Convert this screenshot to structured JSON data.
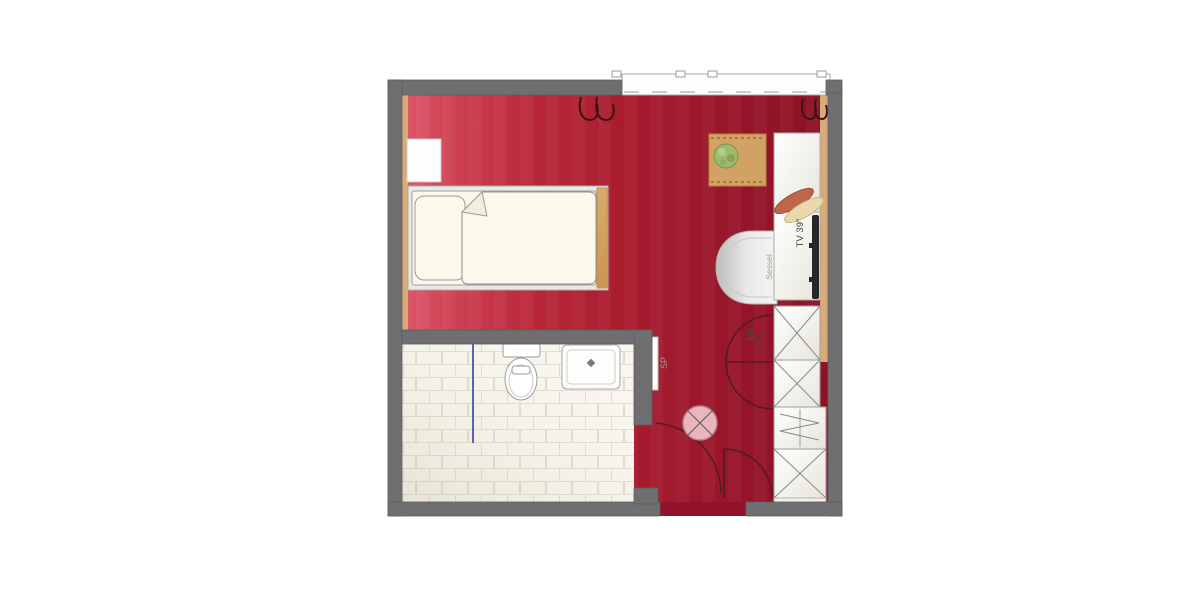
{
  "floorplan": {
    "labels": {
      "tv": "TV 39\"",
      "minibar": "MB",
      "mirror": "SP",
      "armchair": "Sessel"
    },
    "colors": {
      "wall": "#6f6f72",
      "floor_red_left": "#dd5a6b",
      "floor_red_mid": "#a81c2e",
      "floor_red_right": "#8c1224",
      "bathroom_tile": "#f8f6ee",
      "tile_joint": "#e0dccd",
      "wood_trim": "#d9ab79",
      "bed_linen": "#faf7e9",
      "furniture_white": "#fbfbf8",
      "tv_screen": "#27272b",
      "column_pink": "#e9b6be",
      "plant_green": "#9dba6d",
      "shower_screen_blue": "#5a62b5",
      "door_arc": "#4a1b20"
    },
    "symbols": {
      "radiator": "wavy-loop-symbol",
      "column": "circle-with-diagonal-cross",
      "wardrobe_section": "rectangle-with-x-cross",
      "luggage_rack": "rectangle-with-zigzag",
      "door_swing": "quarter-circle-arc",
      "window": "white-band-with-dashed-line"
    }
  }
}
